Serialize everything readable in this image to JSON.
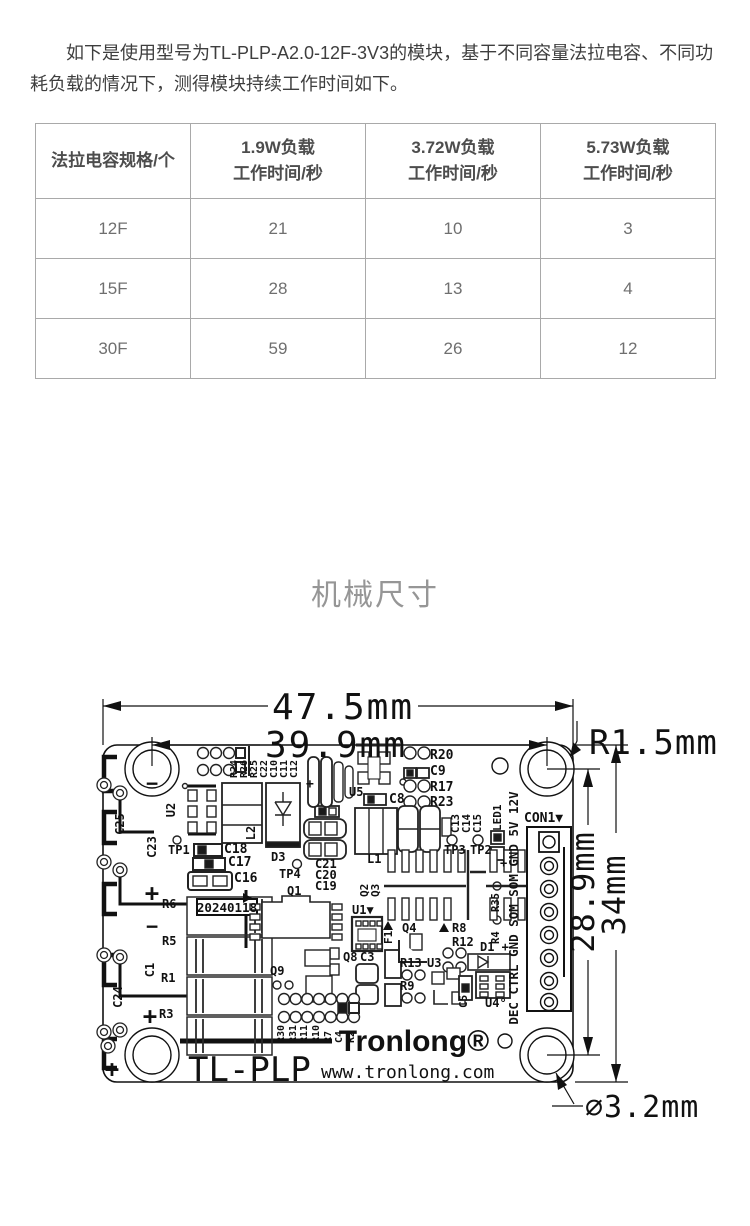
{
  "intro": {
    "text": "如下是使用型号为TL-PLP-A2.0-12F-3V3的模块，基于不同容量法拉电容、不同功耗负载的情况下，测得模块持续工作时间如下。"
  },
  "table": {
    "headers": [
      [
        "法拉电容规格/个",
        ""
      ],
      [
        "1.9W负载",
        "工作时间/秒"
      ],
      [
        "3.72W负载",
        "工作时间/秒"
      ],
      [
        "5.73W负载",
        "工作时间/秒"
      ]
    ],
    "rows": [
      [
        "12F",
        "21",
        "10",
        "3"
      ],
      [
        "15F",
        "28",
        "13",
        "4"
      ],
      [
        "30F",
        "59",
        "26",
        "12"
      ]
    ]
  },
  "section": {
    "title": "机械尺寸"
  },
  "pcb": {
    "labels": [
      {
        "n": "dim-width-outer",
        "t": "47.5mm",
        "x": 343,
        "y": 719,
        "s": 36,
        "a": "m",
        "w": "n",
        "ls": 2
      },
      {
        "n": "dim-width-holes",
        "t": "39.9mm",
        "x": 336,
        "y": 757,
        "s": 36,
        "a": "m",
        "w": "n",
        "ls": 2
      },
      {
        "n": "dim-corner-radius",
        "t": "R1.5mm",
        "x": 589,
        "y": 754,
        "s": 34,
        "w": "n",
        "ls": 1
      },
      {
        "n": "dim-height-holes",
        "t": "28.9mm",
        "x": 594,
        "y": 892,
        "s": 32,
        "a": "m",
        "r": -90,
        "w": "n",
        "ls": 1
      },
      {
        "n": "dim-height-outer",
        "t": "34mm",
        "x": 625,
        "y": 895,
        "s": 32,
        "a": "m",
        "r": -90,
        "w": "n",
        "ls": 1
      },
      {
        "n": "dim-hole-diameter",
        "t": "∅3.2mm",
        "x": 585,
        "y": 1117,
        "s": 30,
        "w": "n",
        "ls": 1
      },
      {
        "n": "brand",
        "t": "Tronlong®",
        "x": 414,
        "y": 1051,
        "s": 30,
        "a": "m",
        "f": "sans"
      },
      {
        "n": "model",
        "t": "TL-PLP",
        "x": 188,
        "y": 1081,
        "s": 34,
        "w": "n"
      },
      {
        "n": "website",
        "t": "www.tronlong.com",
        "x": 321,
        "y": 1078,
        "s": 18,
        "w": "n"
      },
      {
        "n": "date-code",
        "t": "20240118",
        "x": 227,
        "y": 912,
        "s": 12.5,
        "a": "m"
      },
      {
        "t": "C25",
        "x": 124,
        "y": 824,
        "r": -90,
        "a": "m",
        "s": 12
      },
      {
        "t": "C23",
        "x": 156,
        "y": 847,
        "r": -90,
        "a": "m",
        "s": 12
      },
      {
        "t": "C24",
        "x": 122,
        "y": 997,
        "r": -90,
        "a": "m",
        "s": 12
      },
      {
        "t": "C1",
        "x": 154,
        "y": 970,
        "r": -90,
        "a": "m",
        "s": 12
      },
      {
        "t": "U2",
        "x": 175,
        "y": 810,
        "r": -90,
        "a": "m",
        "s": 12
      },
      {
        "t": "L2",
        "x": 255,
        "y": 833,
        "r": -90,
        "a": "m",
        "s": 12
      },
      {
        "t": "TP1",
        "x": 168,
        "y": 854,
        "s": 12
      },
      {
        "t": "C18",
        "x": 224,
        "y": 853,
        "s": 13
      },
      {
        "t": "C17",
        "x": 228,
        "y": 866,
        "s": 13
      },
      {
        "t": "C16",
        "x": 234,
        "y": 882,
        "s": 13
      },
      {
        "t": "R6",
        "x": 162,
        "y": 908,
        "s": 12
      },
      {
        "t": "R5",
        "x": 162,
        "y": 945,
        "s": 12
      },
      {
        "t": "R1",
        "x": 161,
        "y": 982,
        "s": 12
      },
      {
        "t": "R3",
        "x": 159,
        "y": 1018,
        "s": 12
      },
      {
        "n": "minus-1",
        "t": "−",
        "x": 152,
        "y": 790,
        "s": 20,
        "a": "m"
      },
      {
        "n": "plus-1",
        "t": "+",
        "x": 152,
        "y": 901,
        "s": 24,
        "a": "m"
      },
      {
        "n": "minus-2",
        "t": "−",
        "x": 152,
        "y": 933,
        "s": 20,
        "a": "m"
      },
      {
        "n": "plus-2",
        "t": "+",
        "x": 150,
        "y": 1024,
        "s": 24,
        "a": "m"
      },
      {
        "n": "plus-3",
        "t": "+",
        "x": 112,
        "y": 1077,
        "s": 24,
        "a": "m"
      },
      {
        "t": "R24",
        "x": 237,
        "y": 778,
        "r": -90,
        "s": 10
      },
      {
        "t": "R26",
        "x": 247,
        "y": 778,
        "r": -90,
        "s": 10
      },
      {
        "t": "R25",
        "x": 257,
        "y": 778,
        "r": -90,
        "s": 10
      },
      {
        "t": "C22",
        "x": 267,
        "y": 778,
        "r": -90,
        "s": 10
      },
      {
        "t": "C10",
        "x": 277,
        "y": 778,
        "r": -90,
        "s": 10
      },
      {
        "t": "C11",
        "x": 287,
        "y": 778,
        "r": -90,
        "s": 10
      },
      {
        "t": "C12",
        "x": 297,
        "y": 778,
        "r": -90,
        "s": 10
      },
      {
        "n": "plus-c12",
        "t": "+",
        "x": 306,
        "y": 788,
        "s": 13
      },
      {
        "t": "U5",
        "x": 349,
        "y": 796,
        "s": 12
      },
      {
        "t": "C8",
        "x": 389,
        "y": 803,
        "s": 13
      },
      {
        "t": "R20",
        "x": 430,
        "y": 759,
        "s": 13
      },
      {
        "t": "C9",
        "x": 430,
        "y": 775,
        "s": 13
      },
      {
        "t": "R17",
        "x": 430,
        "y": 791,
        "s": 13
      },
      {
        "t": "R23",
        "x": 430,
        "y": 806,
        "s": 13
      },
      {
        "t": "C13",
        "x": 459,
        "y": 833,
        "r": -90,
        "s": 10.5
      },
      {
        "t": "C14",
        "x": 470,
        "y": 833,
        "r": -90,
        "s": 10.5
      },
      {
        "t": "C15",
        "x": 481,
        "y": 833,
        "r": -90,
        "s": 10.5
      },
      {
        "t": "TP3",
        "x": 444,
        "y": 854,
        "s": 12
      },
      {
        "t": "TP2",
        "x": 470,
        "y": 854,
        "s": 12
      },
      {
        "t": "LED1",
        "x": 501,
        "y": 831,
        "r": -90,
        "s": 11
      },
      {
        "n": "plus-led",
        "t": "+",
        "x": 500,
        "y": 867,
        "s": 12
      },
      {
        "t": "R35",
        "x": 499,
        "y": 912,
        "r": -90,
        "s": 10.5
      },
      {
        "t": "R4",
        "x": 499,
        "y": 944,
        "r": -90,
        "s": 10.5
      },
      {
        "n": "con1-pin-names",
        "t": "DEC CTRL GND SOM SOM GND 5V 12V",
        "x": 518,
        "y": 908,
        "r": -90,
        "a": "m",
        "s": 12.5
      },
      {
        "n": "con1",
        "t": "CON1▼",
        "x": 524,
        "y": 822,
        "s": 13
      },
      {
        "t": "D3",
        "x": 271,
        "y": 861,
        "s": 12
      },
      {
        "t": "TP4",
        "x": 279,
        "y": 878,
        "s": 12
      },
      {
        "t": "C21",
        "x": 315,
        "y": 868,
        "s": 12
      },
      {
        "t": "C20",
        "x": 315,
        "y": 879,
        "s": 12
      },
      {
        "t": "C19",
        "x": 315,
        "y": 890,
        "s": 12
      },
      {
        "t": "Q1",
        "x": 287,
        "y": 895,
        "s": 12
      },
      {
        "t": "L1",
        "x": 367,
        "y": 863,
        "s": 12
      },
      {
        "t": "Q2",
        "x": 368,
        "y": 897,
        "r": -90,
        "s": 11
      },
      {
        "t": "Q3",
        "x": 379,
        "y": 897,
        "r": -90,
        "s": 11
      },
      {
        "n": "U1",
        "t": "U1▼",
        "x": 352,
        "y": 914,
        "s": 12
      },
      {
        "t": "F1",
        "x": 392,
        "y": 944,
        "r": -90,
        "s": 11
      },
      {
        "t": "Q4",
        "x": 402,
        "y": 932,
        "s": 12
      },
      {
        "t": "R8",
        "x": 452,
        "y": 932,
        "s": 12
      },
      {
        "t": "R12",
        "x": 452,
        "y": 946,
        "s": 12
      },
      {
        "t": "Q8",
        "x": 343,
        "y": 961,
        "s": 12
      },
      {
        "t": "C3",
        "x": 360,
        "y": 961,
        "s": 12
      },
      {
        "t": "R13",
        "x": 400,
        "y": 967,
        "s": 12
      },
      {
        "t": "U3",
        "x": 427,
        "y": 967,
        "s": 12
      },
      {
        "t": "R9",
        "x": 400,
        "y": 990,
        "s": 12
      },
      {
        "n": "D1",
        "t": "D1 +",
        "x": 480,
        "y": 951,
        "s": 12
      },
      {
        "t": "C5",
        "x": 467,
        "y": 1008,
        "r": -90,
        "s": 11
      },
      {
        "n": "U4",
        "t": "U4°",
        "x": 485,
        "y": 1007,
        "s": 12
      },
      {
        "t": "Q9",
        "x": 270,
        "y": 975,
        "s": 12
      },
      {
        "t": "R30",
        "x": 284,
        "y": 1043,
        "r": -90,
        "s": 10
      },
      {
        "t": "R31",
        "x": 296,
        "y": 1043,
        "r": -90,
        "s": 10
      },
      {
        "t": "R11",
        "x": 307,
        "y": 1043,
        "r": -90,
        "s": 10
      },
      {
        "t": "R10",
        "x": 319,
        "y": 1043,
        "r": -90,
        "s": 10
      },
      {
        "t": "R7",
        "x": 331,
        "y": 1043,
        "r": -90,
        "s": 10
      },
      {
        "t": "C4",
        "x": 342,
        "y": 1043,
        "r": -90,
        "s": 10
      },
      {
        "t": "R2",
        "x": 354,
        "y": 1043,
        "r": -90,
        "s": 10
      }
    ]
  }
}
